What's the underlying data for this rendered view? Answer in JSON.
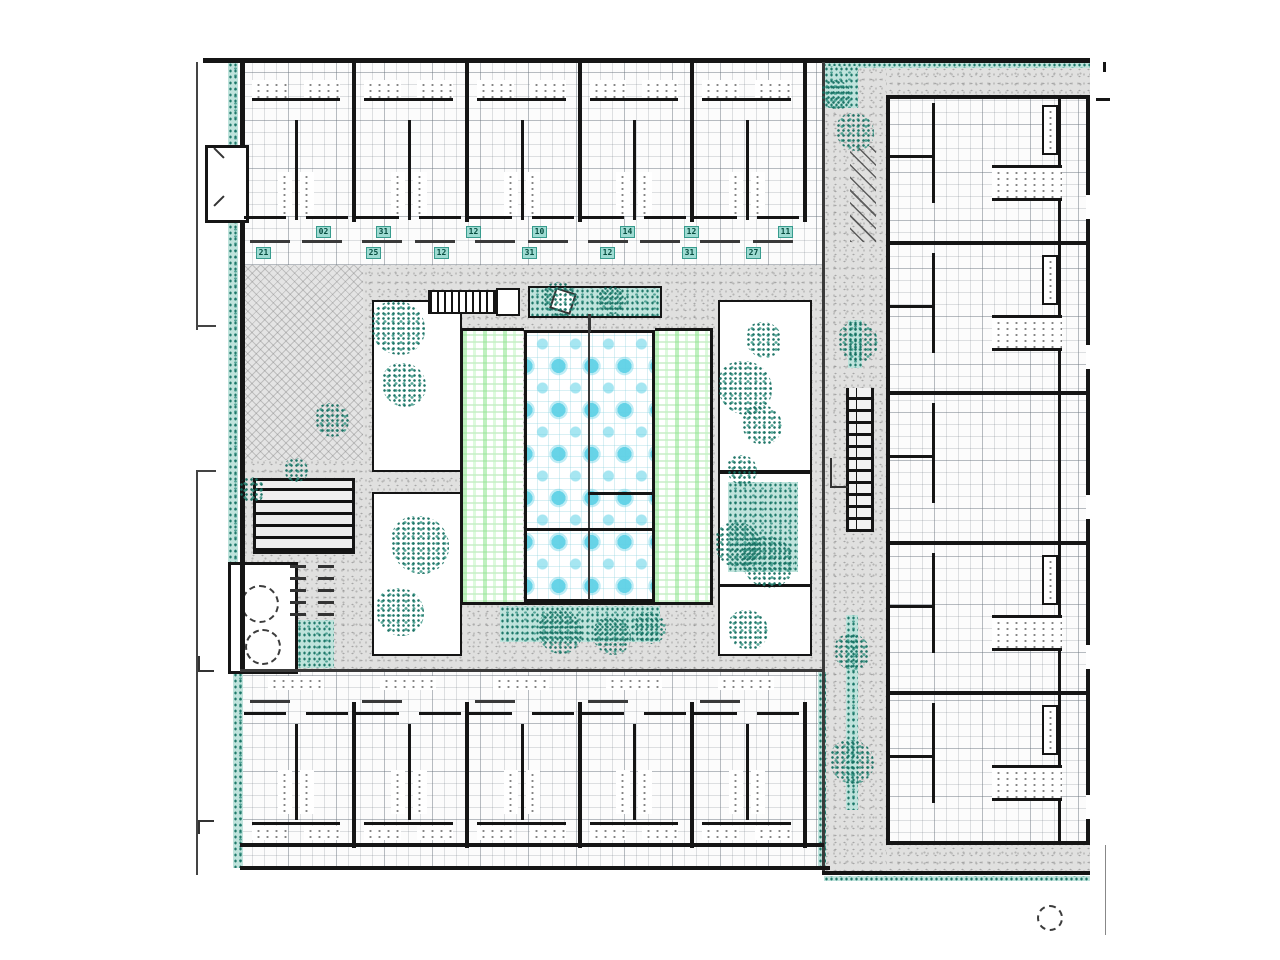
{
  "plan": {
    "kind": "courtyard-building-floor-plan",
    "room_tags": {
      "upper_row": [
        {
          "x": 316,
          "label": "02"
        },
        {
          "x": 376,
          "label": "31"
        },
        {
          "x": 466,
          "label": "12"
        },
        {
          "x": 532,
          "label": "10"
        },
        {
          "x": 620,
          "label": "14"
        },
        {
          "x": 684,
          "label": "12"
        },
        {
          "x": 778,
          "label": "11"
        }
      ],
      "lower_row": [
        {
          "x": 256,
          "label": "21"
        },
        {
          "x": 366,
          "label": "25"
        },
        {
          "x": 434,
          "label": "12"
        },
        {
          "x": 522,
          "label": "31"
        },
        {
          "x": 600,
          "label": "12"
        },
        {
          "x": 682,
          "label": "31"
        },
        {
          "x": 746,
          "label": "27"
        }
      ]
    },
    "symbols": {
      "site_marker": "dashed-circle"
    },
    "colors": {
      "wall": "#151515",
      "plaza_concrete": "#e0e0df",
      "vegetation_teal": "#2e8d7e",
      "pool_cyan": "#5ed1e6",
      "planting_band_green": "#8ce68c",
      "tag_background": "#9edbd2"
    }
  }
}
